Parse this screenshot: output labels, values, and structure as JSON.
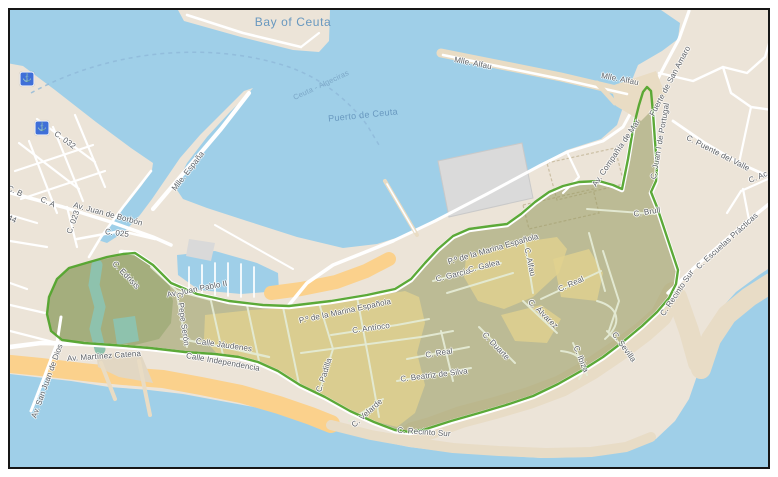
{
  "map": {
    "colors": {
      "water": "#9fcfe8",
      "land": "#ece4d8",
      "sandOrange": "#fbd18c",
      "sandPale": "#e8dcc6",
      "zoneFill": "rgba(149,153,95,0.55)",
      "zonePark": "rgba(110,145,70,0.30)",
      "zoneYellow": "#e1d28e",
      "moat": "#8ec2ad",
      "zoneStroke": "#53a42d",
      "road": "#ffffff",
      "innerStreet": "#e4ead4",
      "building": "#dadada",
      "iconBlue": "#3f6fd8",
      "labelRoad": "#5d6166",
      "labelWater": "#6898bf",
      "ferryRoute": "#8fb8d8"
    },
    "labels": [
      [
        "Bay of Ceuta",
        292,
        21,
        0,
        "water-lg"
      ],
      [
        "Ceuta - Algeciras",
        320,
        84,
        -25,
        "water-sm"
      ],
      [
        "Puerto de Ceuta",
        362,
        114,
        -6,
        "water"
      ],
      [
        "Mlle. Alfau",
        472,
        62,
        11,
        "road"
      ],
      [
        "Mlle. Alfau",
        619,
        78,
        11,
        "road"
      ],
      [
        "Fuerte de San Amaro",
        669,
        80,
        -62,
        "road"
      ],
      [
        "C. Puente del Valle",
        717,
        152,
        27,
        "road"
      ],
      [
        "C. Ac",
        757,
        176,
        -22,
        "road"
      ],
      [
        "C. Escuelas Prácticas",
        726,
        240,
        -42,
        "road"
      ],
      [
        "C. Recinto Sur",
        676,
        292,
        -56,
        "road"
      ],
      [
        "C. Recinto Sur",
        423,
        431,
        4,
        "road"
      ],
      [
        "C. Sevilla",
        623,
        346,
        54,
        "road"
      ],
      [
        "C. Ibiza",
        580,
        358,
        68,
        "road"
      ],
      [
        "C. Álvarez",
        542,
        313,
        44,
        "road"
      ],
      [
        "C. Duarte",
        495,
        345,
        46,
        "road"
      ],
      [
        "C. Real",
        570,
        283,
        -24,
        "road"
      ],
      [
        "C. Real",
        438,
        352,
        -9,
        "road"
      ],
      [
        "C. Beatriz de Silva",
        433,
        374,
        -7,
        "road"
      ],
      [
        "C. Velarde",
        366,
        412,
        -42,
        "road"
      ],
      [
        "C. Padilla",
        323,
        374,
        -72,
        "road"
      ],
      [
        "Calle Jáudenes",
        223,
        344,
        8,
        "road"
      ],
      [
        "Calle Independencia",
        222,
        361,
        10,
        "road"
      ],
      [
        "Av. Martínez Catena",
        103,
        355,
        -4,
        "road"
      ],
      [
        "Av. San Juan de Dios",
        46,
        380,
        -70,
        "road"
      ],
      [
        "C. Pepe Serón",
        182,
        318,
        82,
        "road"
      ],
      [
        "Av. Juan Pablo II",
        196,
        288,
        -11,
        "road"
      ],
      [
        "P.º de la Marina Española",
        344,
        310,
        -12,
        "road"
      ],
      [
        "P.º de la Marina Española",
        492,
        248,
        -16,
        "road"
      ],
      [
        "C. García",
        452,
        274,
        -14,
        "road"
      ],
      [
        "C. Galea",
        483,
        265,
        -14,
        "road"
      ],
      [
        "C. Alfau",
        529,
        261,
        78,
        "road"
      ],
      [
        "C. Antíoco",
        370,
        327,
        -8,
        "road"
      ],
      [
        "C. Brull",
        646,
        211,
        -9,
        "road"
      ],
      [
        "Av. Compañía de Mar",
        615,
        152,
        -56,
        "road"
      ],
      [
        "C. Juan I de Portugal",
        659,
        140,
        -80,
        "road"
      ],
      [
        "C. Edrisis",
        125,
        274,
        46,
        "road"
      ],
      [
        "Av. Juan de Borbón",
        107,
        213,
        15,
        "road"
      ],
      [
        "C. 025",
        116,
        232,
        7,
        "road"
      ],
      [
        "C. 023",
        72,
        221,
        -70,
        "road"
      ],
      [
        "C. A",
        47,
        201,
        25,
        "road"
      ],
      [
        "C. B",
        14,
        190,
        25,
        "road"
      ],
      [
        "44",
        11,
        218,
        25,
        "road"
      ],
      [
        "C. 032",
        64,
        139,
        36,
        "road"
      ],
      [
        "Mlle. España",
        187,
        170,
        -52,
        "road"
      ]
    ],
    "icons": [
      {
        "name": "ferry-terminal-icon",
        "glyph": "⚓",
        "x": 26,
        "y": 78
      },
      {
        "name": "ferry-terminal-icon",
        "glyph": "⚓",
        "x": 41,
        "y": 127
      }
    ]
  }
}
